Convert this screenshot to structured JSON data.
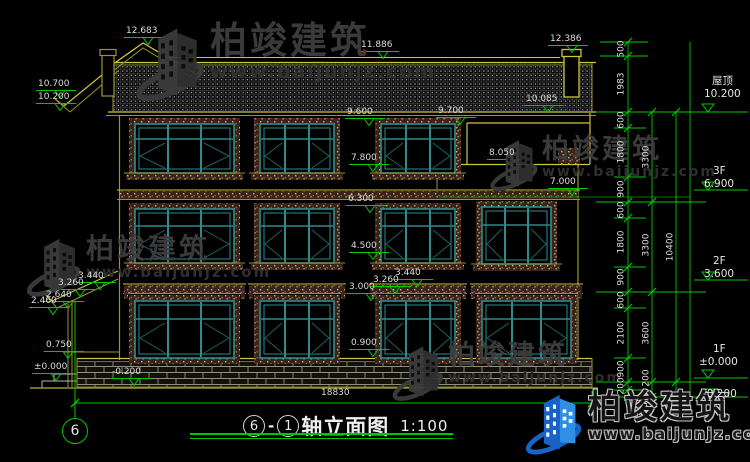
{
  "palette": {
    "background": "#000000",
    "dimension_green": "#00c800",
    "cad_yellow": "#9a942f",
    "cad_bright_yellow": "#cfc33f",
    "window_teal": "#2e8b8b",
    "label_white": "#dcdcdc",
    "watermark_gray": "#3e3e3e",
    "brand_blue": "#1a63c6"
  },
  "watermark": {
    "brand": "柏竣建筑",
    "url": "www.baijunjz.com"
  },
  "title": {
    "axis_start": "6",
    "separator": "-",
    "axis_end": "1",
    "name": "轴立面图",
    "scale": "1:100"
  },
  "axis_bubble": {
    "label": "6"
  },
  "overall_dimension": "18830",
  "floor_levels": [
    {
      "name": "屋顶",
      "elevation": "10.200",
      "nx": 712,
      "ny": 76,
      "ex": 704,
      "ey": 89,
      "my": 112
    },
    {
      "name": "3F",
      "elevation": "6.900",
      "nx": 713,
      "ny": 166,
      "ex": 704,
      "ey": 179,
      "my": 190
    },
    {
      "name": "2F",
      "elevation": "3.600",
      "nx": 713,
      "ny": 256,
      "ex": 704,
      "ey": 269,
      "my": 280
    },
    {
      "name": "1F",
      "elevation": "±0.000",
      "nx": 713,
      "ny": 344,
      "ex": 699,
      "ey": 357,
      "my": 378
    },
    {
      "name": "",
      "elevation": "-0.200",
      "nx": 0,
      "ny": 0,
      "ex": 703,
      "ey": 389,
      "my": 397
    }
  ],
  "elevation_marks": [
    {
      "v": "12.683",
      "x": 126,
      "y": 27
    },
    {
      "v": "10.700",
      "x": 38,
      "y": 80
    },
    {
      "v": "10.200",
      "x": 38,
      "y": 93
    },
    {
      "v": "11.886",
      "x": 361,
      "y": 41
    },
    {
      "v": "12.386",
      "x": 550,
      "y": 35
    },
    {
      "v": "10.085",
      "x": 526,
      "y": 95
    },
    {
      "v": "9.700",
      "x": 438,
      "y": 107
    },
    {
      "v": "9.600",
      "x": 347,
      "y": 108
    },
    {
      "v": "8.050",
      "x": 489,
      "y": 149
    },
    {
      "v": "7.800",
      "x": 351,
      "y": 154
    },
    {
      "v": "7.000",
      "x": 550,
      "y": 178
    },
    {
      "v": "6.300",
      "x": 348,
      "y": 195
    },
    {
      "v": "4.500",
      "x": 351,
      "y": 242
    },
    {
      "v": "3.440",
      "x": 395,
      "y": 269
    },
    {
      "v": "3.260",
      "x": 373,
      "y": 276
    },
    {
      "v": "3.000",
      "x": 349,
      "y": 283
    },
    {
      "v": "3.440",
      "x": 78,
      "y": 272
    },
    {
      "v": "3.260",
      "x": 58,
      "y": 279
    },
    {
      "v": "2.640",
      "x": 46,
      "y": 291
    },
    {
      "v": "2.460",
      "x": 31,
      "y": 297
    },
    {
      "v": "0.900",
      "x": 351,
      "y": 339
    },
    {
      "v": "0.750",
      "x": 46,
      "y": 341
    },
    {
      "v": "±0.000",
      "x": 34,
      "y": 363
    },
    {
      "v": "-0.200",
      "x": 112,
      "y": 368
    }
  ],
  "chain_labels": {
    "inner_x": 622,
    "middle_x": 647,
    "outer_x": 671,
    "inner": [
      {
        "v": "500",
        "y": 49
      },
      {
        "v": "1983",
        "y": 84
      },
      {
        "v": "600",
        "y": 120
      },
      {
        "v": "1800",
        "y": 152
      },
      {
        "v": "900",
        "y": 189
      },
      {
        "v": "600",
        "y": 210
      },
      {
        "v": "1800",
        "y": 242
      },
      {
        "v": "900",
        "y": 277
      },
      {
        "v": "600",
        "y": 300
      },
      {
        "v": "2100",
        "y": 333
      },
      {
        "v": "900",
        "y": 369
      },
      {
        "v": "200",
        "y": 386
      }
    ],
    "middle": [
      {
        "v": "3300",
        "y": 157
      },
      {
        "v": "3300",
        "y": 245
      },
      {
        "v": "3600",
        "y": 333
      },
      {
        "v": "200",
        "y": 378
      }
    ],
    "outer": [
      {
        "v": "10400",
        "y": 247
      }
    ]
  }
}
